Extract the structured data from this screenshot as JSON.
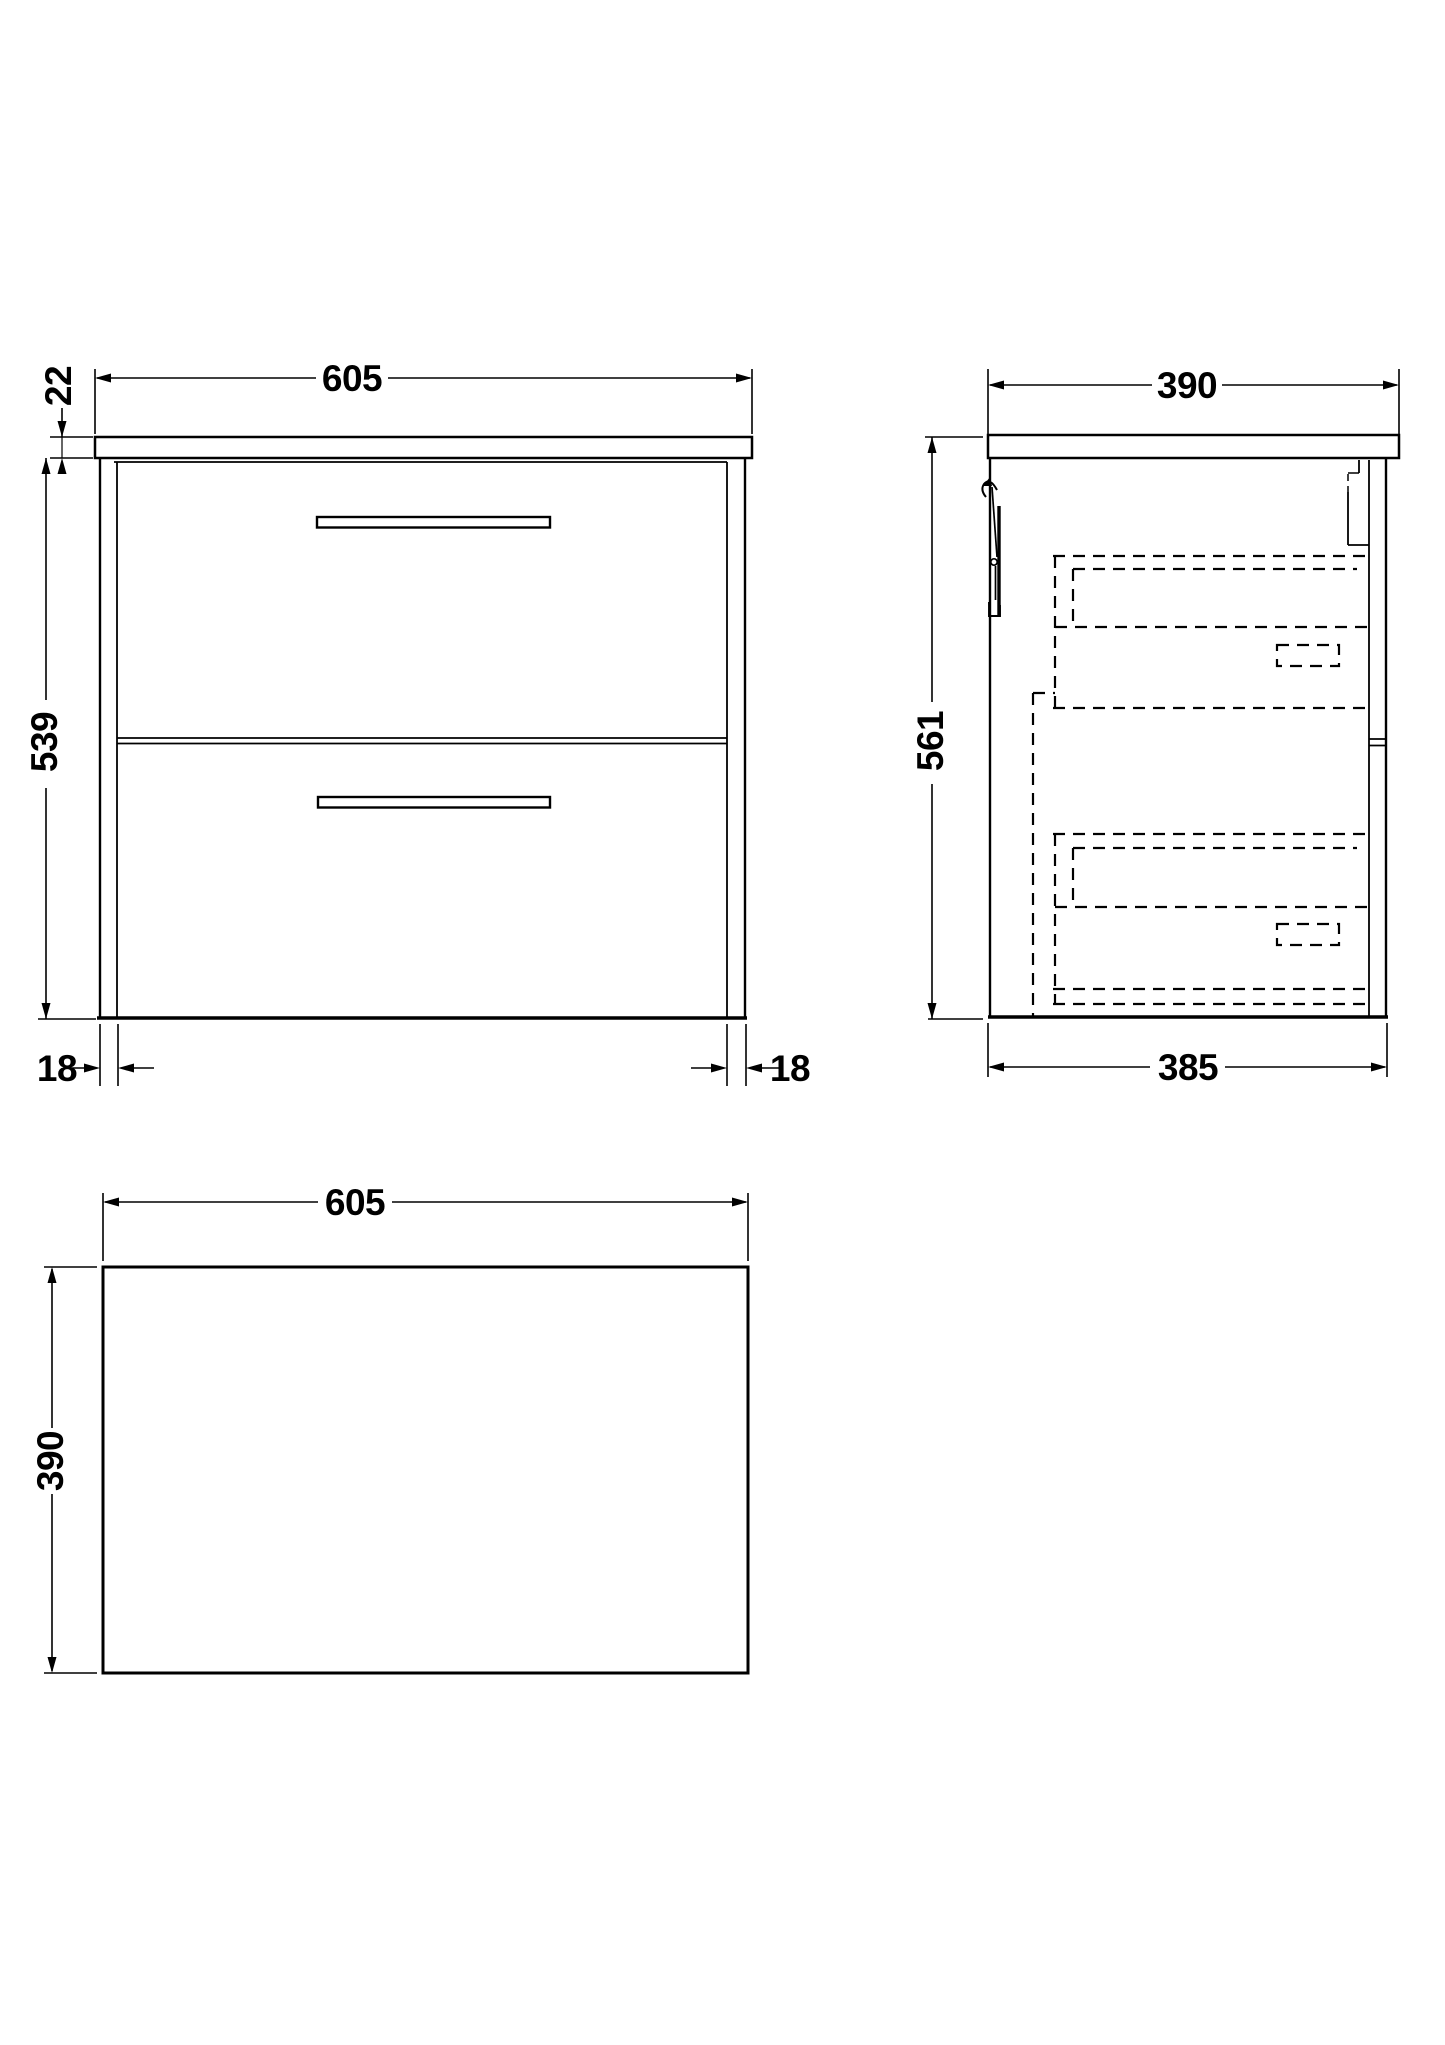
{
  "drawing": {
    "title": "wall-hung two-drawer vanity unit technical drawing",
    "line_color": "#000000",
    "background_color": "#ffffff",
    "views": [
      {
        "id": "front-elevation"
      },
      {
        "id": "side-section"
      },
      {
        "id": "plan-view"
      }
    ],
    "dims": {
      "front_width": "605",
      "worktop_thickness": "22",
      "cabinet_height": "539",
      "panel_left": "18",
      "panel_right": "18",
      "side_depth": "390",
      "side_height": "561",
      "side_bottom_depth": "385",
      "plan_width": "605",
      "plan_depth": "390"
    }
  }
}
